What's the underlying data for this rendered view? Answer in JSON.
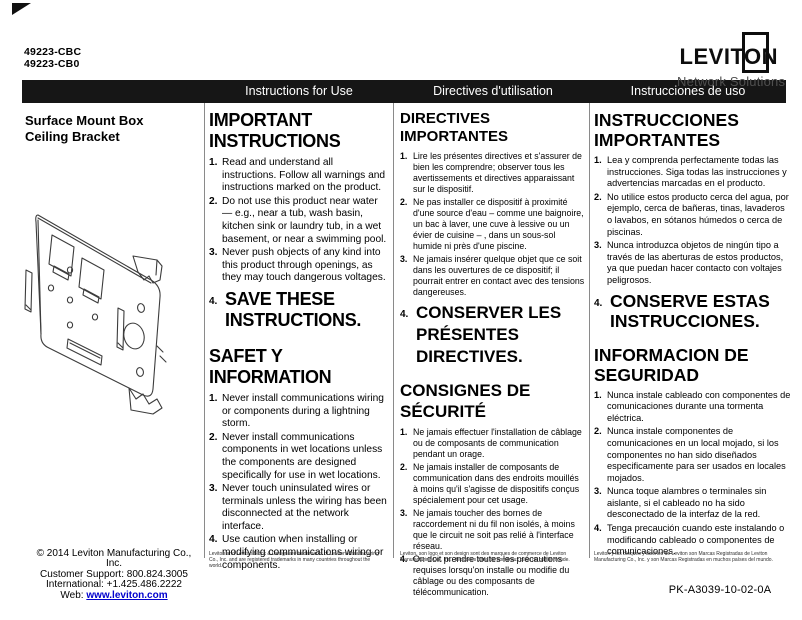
{
  "page": {
    "part_numbers": [
      "49223-CBC",
      "49223-CB0"
    ],
    "product_title_line1": "Surface Mount Box",
    "product_title_line2": "Ceiling Bracket",
    "doc_code": "PK-A3039-10-02-0A"
  },
  "logo": {
    "brand": "LEVITON",
    "tagline": "Network Solutions"
  },
  "bar": {
    "english": "Instructions for Use",
    "french": "Directives d'utilisation",
    "spanish": "Instrucciones de uso"
  },
  "cols": {
    "en": {
      "title1": "IMPORTANT INSTRUCTIONS",
      "items1": [
        {
          "n": "1.",
          "text": "Read and understand all instructions. Follow all warnings and instructions marked on the product."
        },
        {
          "n": "2.",
          "text": "Do not use this product near water — e.g., near a tub, wash basin, kitchen sink or laundry tub, in a wet basement, or near a swimming pool."
        },
        {
          "n": "3.",
          "text": "Never push objects of any kind into this product through openings, as they may touch dangerous voltages."
        }
      ],
      "big4": {
        "n": "4.",
        "text": "SAVE THESE INSTRUCTIONS."
      },
      "title2": "SAFET Y INFORMATION",
      "items2": [
        {
          "n": "1.",
          "text": "Never install communications wiring or components during a lightning storm."
        },
        {
          "n": "2.",
          "text": "Never install communications components in wet locations unless the components are designed specifically for use in wet locations."
        },
        {
          "n": "3.",
          "text": "Never touch uninsulated wires or terminals unless the wiring has been disconnected at the network interface."
        },
        {
          "n": "4.",
          "text": "Use caution when installing or modifying communications wiring or components."
        }
      ],
      "footnote": "Leviton and Leviton Block & Design are trademarks of Leviton Manufacturing Co., Inc. and are registered trademarks in many countries throughout the world."
    },
    "fr": {
      "title1": "DIRECTIVES IMPORTANTES",
      "items1": [
        {
          "n": "1.",
          "text": "Lire les présentes directives et s'assurer de bien les comprendre; observer tous les avertissements et directives apparaissant sur le dispositif."
        },
        {
          "n": "2.",
          "text": "Ne pas installer ce dispositif à proximité d'une source d'eau – comme une baignoire, un bac à laver, une cuve à lessive ou un évier de cuisine – , dans un sous-sol humide ni près d'une piscine."
        },
        {
          "n": "3.",
          "text": "Ne jamais insérer quelque objet que ce soit dans les ouvertures de ce dispositif; il pourrait entrer en contact avec des tensions dangereuses."
        }
      ],
      "big4": {
        "n": "4.",
        "text": "CONSERVER LES PRÉSENTES DIRECTIVES."
      },
      "title2": "CONSIGNES DE SÉCURITÉ",
      "items2": [
        {
          "n": "1.",
          "text": "Ne jamais effectuer l'installation de câblage ou de composants de communication pendant un orage."
        },
        {
          "n": "2.",
          "text": "Ne jamais installer de composants de communication dans des endroits mouillés à moins qu'il s'agisse de dispositifs conçus spécialement pour cet usage."
        },
        {
          "n": "3.",
          "text": "Ne jamais toucher des bornes de raccordement ni du fil non isolés, à moins que le circuit ne soit pas relié à l'interface réseau."
        },
        {
          "n": "4.",
          "text": "On doit prendre toutes les précautions requises lorsqu'on installe ou modifie du câblage ou des composants de télécommunication."
        }
      ],
      "footnote": "Leviton, son logo et son design sont des marques de commerce de Leviton Manufacturing Co., Inc., déposées dans de nombreux pays de par le monde."
    },
    "es": {
      "title1": "INSTRUCCIONES IMPORTANTES",
      "items1": [
        {
          "n": "1.",
          "text": "Lea y comprenda perfectamente todas las instrucciones. Siga todas las instrucciones y advertencias marcadas en el producto."
        },
        {
          "n": "2.",
          "text": "No utilice estos producto cerca del agua, por ejemplo, cerca de bañeras, tinas, lavaderos o lavabos, en sótanos húmedos o cerca de piscinas."
        },
        {
          "n": "3.",
          "text": "Nunca introduzca objetos de ningún tipo a través de las aberturas de estos productos, ya que puedan hacer contacto con voltajes peligrosos."
        }
      ],
      "big4": {
        "n": "4.",
        "text": "CONSERVE ESTAS INSTRUCCIONES."
      },
      "title2": "INFORMACION DE SEGURIDAD",
      "items2": [
        {
          "n": "1.",
          "text": "Nunca instale cableado con componentes de comunicaciones durante una tormenta eléctrica."
        },
        {
          "n": "2.",
          "text": "Nunca instale componentes de comunicaciones en un local mojado, si los componentes no han sido diseñados especificamente para ser usados en locales mojados."
        },
        {
          "n": "3.",
          "text": "Nunca toque alambres o terminales sin aislante, si el cableado no ha sido desconectado de la interfaz de la red."
        },
        {
          "n": "4.",
          "text": "Tenga precaución cuando este instalando o modificando cableado o componentes de comunicaciones."
        }
      ],
      "footnote": "Leviton y los bloques y diseños de Leviton son Marcas Registradas de Leviton Manufacturing Co., Inc. y son Marcas Registradas en muchos países del mundo."
    }
  },
  "footer": {
    "copyright": "© 2014 Leviton Manufacturing Co., Inc.",
    "support": "Customer Support: 800.824.3005",
    "international": "International: +1.425.486.2222",
    "web_label": "Web: ",
    "web_url": "www.leviton.com"
  },
  "colors": {
    "bar_bg": "#161616",
    "link_blue": "#0000cd",
    "tagline_gray": "#4f4f4f"
  }
}
